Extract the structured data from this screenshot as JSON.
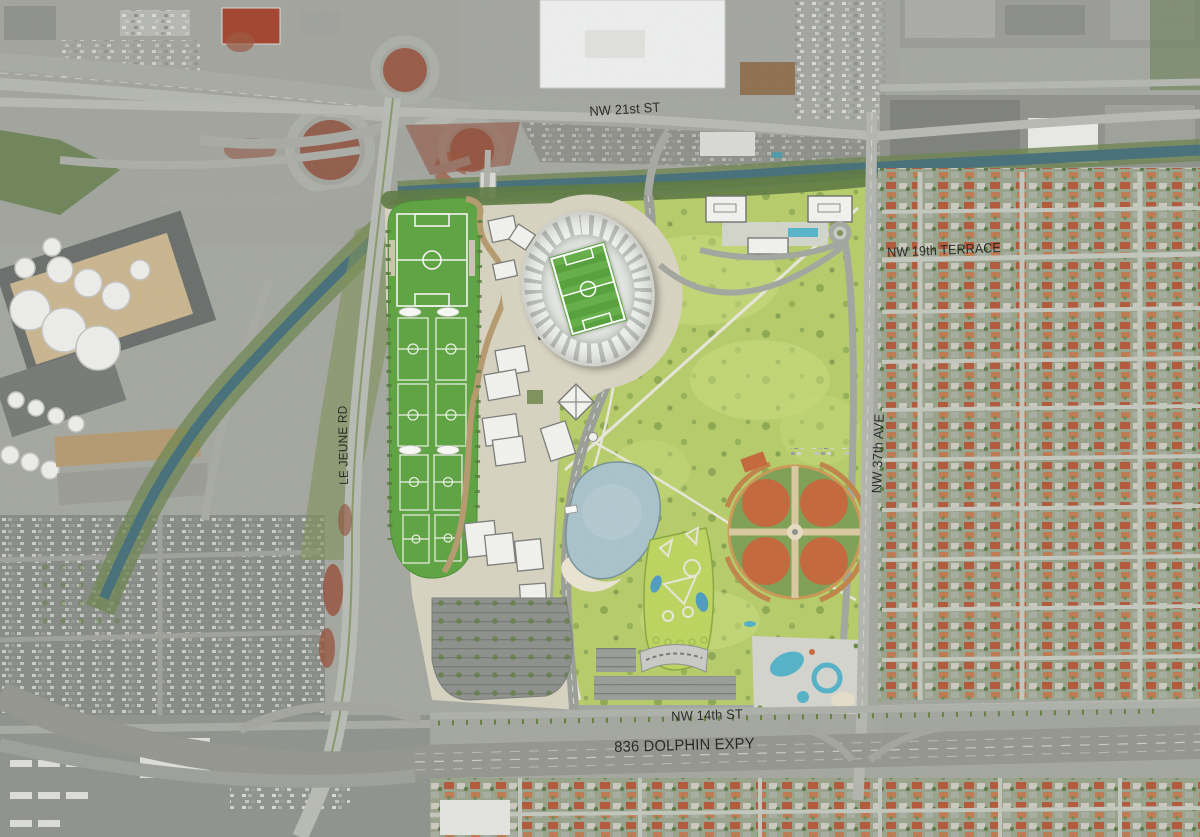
{
  "map": {
    "labels": [
      {
        "id": "nw-21st-st",
        "text": "NW 21st ST"
      },
      {
        "id": "nw-19th-terrace",
        "text": "NW 19th TERRACE"
      },
      {
        "id": "nw-37th-ave",
        "text": "NW 37th AVE"
      },
      {
        "id": "le-jeune-rd",
        "text": "LE JEUNE RD"
      },
      {
        "id": "nw-14th-st",
        "text": "NW 14th ST"
      },
      {
        "id": "836-dolphin-expy",
        "text": "836 DOLPHIN EXPY"
      }
    ],
    "features": [
      "stadium",
      "soccer-practice-fields",
      "office-buildings",
      "hotel-buildings",
      "lake",
      "beach",
      "golf-putting-course",
      "baseball-complex",
      "water-park",
      "surface-parking",
      "highway-interchange",
      "fuel-tank-farm",
      "canal",
      "residential-neighborhood",
      "expressway",
      "warehouses"
    ],
    "colors": {
      "park_green": "#b6cc6a",
      "field_green": "#5ea342",
      "pitch_green": "#5da742",
      "clay_orange": "#c4683c",
      "canal_teal": "#47707a",
      "lake_blue": "#a9c2ca",
      "sand": "#e9e3d0",
      "road_gray": "#b7b9b3",
      "building_white": "#f1f1ee",
      "roof_red": "#b2593b"
    }
  }
}
